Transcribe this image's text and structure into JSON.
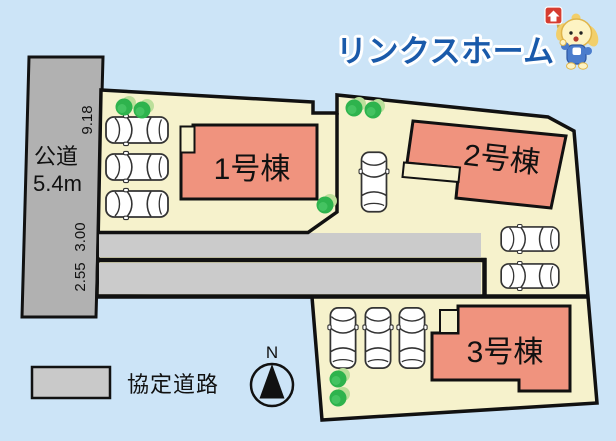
{
  "page": {
    "background_color": "#cce4f7"
  },
  "logo": {
    "text": "リンクスホーム",
    "color": "#1a5aaa",
    "mascot": "mascot-dog-with-flag-icon"
  },
  "site_plan": {
    "public_road": {
      "name": "公道",
      "width": "5.4m",
      "color": "#b1b1b1"
    },
    "dimensions": {
      "road_side": "9.18",
      "agreement_road_upper": "3.00",
      "agreement_road_lower": "2.55"
    },
    "plot_color": "#f6f2cc",
    "building_color": "#f0937e",
    "agreement_road_color": "#cbcbcb",
    "buildings": [
      {
        "label": "1号棟"
      },
      {
        "label": "2号棟"
      },
      {
        "label": "3号棟"
      }
    ],
    "car_count": 9,
    "tree_count": 7
  },
  "legend": {
    "swatch_color": "#c9c9c9",
    "label": "協定道路"
  },
  "compass": {
    "label": "N"
  }
}
